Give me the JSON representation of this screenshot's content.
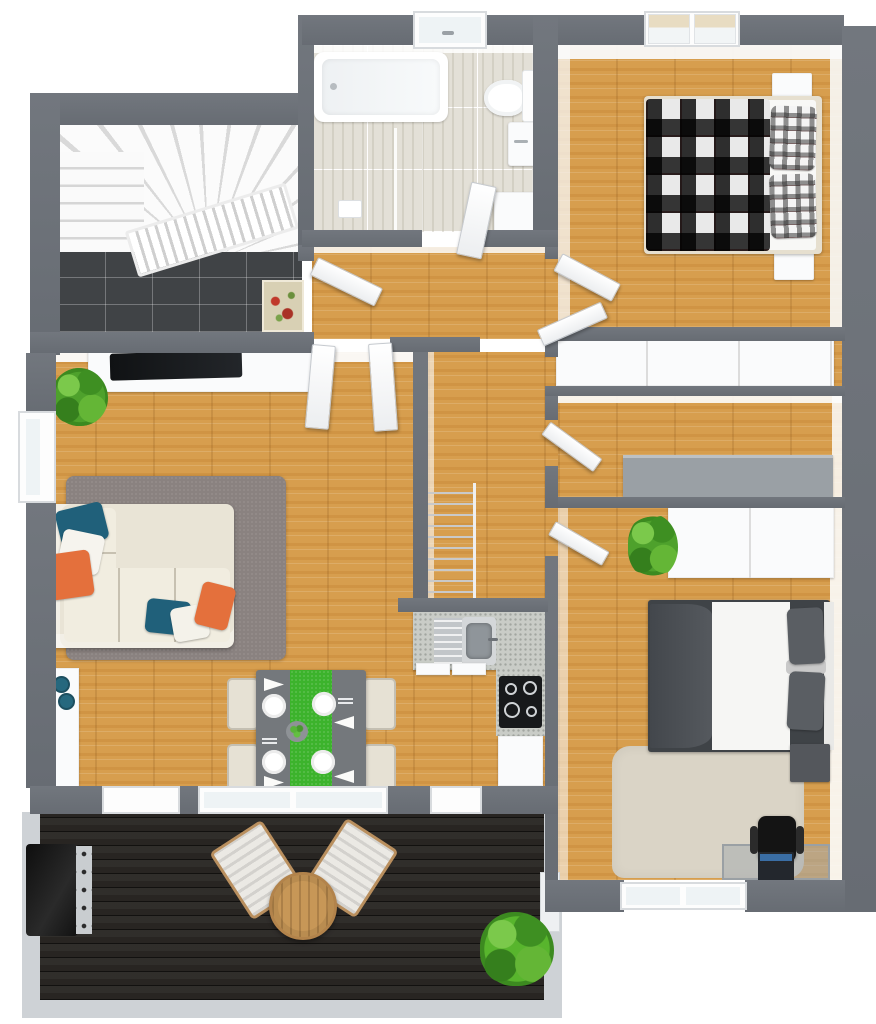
{
  "meta": {
    "view": "3D top-down floor plan render",
    "canvas_width": 876,
    "canvas_height": 1024
  },
  "palette": {
    "bg": "#ffffff",
    "wall": "#676c73",
    "wall-hi": "#72777e",
    "wood": "#d79e4e",
    "bath-tile": "#e3e0d7",
    "entry-tile": "#404346",
    "deck": "#282522",
    "terrace-border": "#ced2d6",
    "white-furn": "#fafbfc",
    "sofa": "#e9e4d6",
    "rug-gray": "#8a8280",
    "rug-beige": "#dad4c6",
    "accent-teal": "#20607a",
    "accent-orange": "#e4703c",
    "plant-green": "#4ea12c",
    "table-green": "#3cb32c",
    "table-gray": "#74787c",
    "counter-speckle": "#c9ccc7",
    "dark-furn": "#3f4347",
    "black-furn": "#17191b",
    "glass": "#eef3f5",
    "wood-table": "#c79757"
  },
  "rooms": {
    "entry": {
      "label": "Entry stairwell",
      "items": {
        "stairs": "Winding staircase",
        "tile": "Dark tile floor",
        "doormat": "Patterned doormat",
        "railing": "Stair railing"
      }
    },
    "bathroom": {
      "label": "Bathroom",
      "items": {
        "bathtub": "Bathtub",
        "shower": "Walk-in shower",
        "toilet": "Toilet",
        "vanity": "Wash basin",
        "cabinet": "Bathroom cabinet",
        "window": "Bathroom window"
      }
    },
    "bedroom1": {
      "label": "Bedroom with plaid bed",
      "items": {
        "bed": "Double bed with plaid blanket",
        "pillow_a": "Plaid pillow",
        "pillow_b": "Plaid pillow",
        "nightstand_a": "Nightstand",
        "nightstand_b": "Nightstand",
        "window": "Double window"
      }
    },
    "hallway": {
      "label": "Hallway"
    },
    "closet": {
      "label": "Closet room",
      "items": {
        "wardrobe": "Built-in wardrobe"
      }
    },
    "storage": {
      "label": "Storage room",
      "items": {
        "counter": "Gray counter"
      }
    },
    "living": {
      "label": "Living room",
      "items": {
        "sideboard": "TV sideboard",
        "tv": "Flat-screen TV",
        "plant": "Potted plant",
        "rug": "Gray area rug",
        "sofa": "Corner sofa",
        "cushion_teal": "Teal cushion",
        "cushion_white": "White cushion",
        "cushion_orange": "Orange cushion",
        "window": "Window"
      }
    },
    "dining": {
      "label": "Dining area",
      "items": {
        "table": "Dining table with green runner",
        "plate": "Place setting",
        "bowl": "Fruit bowl",
        "chair": "Dining chair"
      }
    },
    "kitchen": {
      "label": "Kitchen",
      "items": {
        "sink": "Kitchen sink",
        "drainboard": "Drainboard",
        "cooktop": "Cooktop with four burners",
        "cabinet": "Base cabinet",
        "side_counter": "Side counter with appliance",
        "bowls": "Blue bowls"
      }
    },
    "stairs": {
      "label": "Staircase down"
    },
    "bedroom2": {
      "label": "Bedroom with desk",
      "items": {
        "wardrobe": "Wardrobe",
        "plant": "Potted plant",
        "bed": "Double bed with dark bedding",
        "nightstand": "Nightstand",
        "rug": "Beige rug",
        "desk": "Desk",
        "laptop": "Laptop",
        "chair": "Office chair",
        "window": "Window"
      }
    },
    "terrace": {
      "label": "Terrace",
      "items": {
        "deck": "Dark wood decking",
        "grill": "Barbecue grill",
        "table": "Round wooden table",
        "chair_a": "Deck chair",
        "chair_b": "Deck chair",
        "plant": "Potted palm"
      }
    },
    "doors": {
      "entry": "Entry door",
      "living_a": "Living room door",
      "living_b": "Living room door",
      "bath": "Bathroom door",
      "bedroom1": "Bedroom door",
      "closet": "Closet door",
      "storage": "Storage door",
      "bedroom2": "Bedroom door",
      "terrace_sliding": "Terrace sliding door",
      "terrace_side": "Terrace door"
    }
  }
}
